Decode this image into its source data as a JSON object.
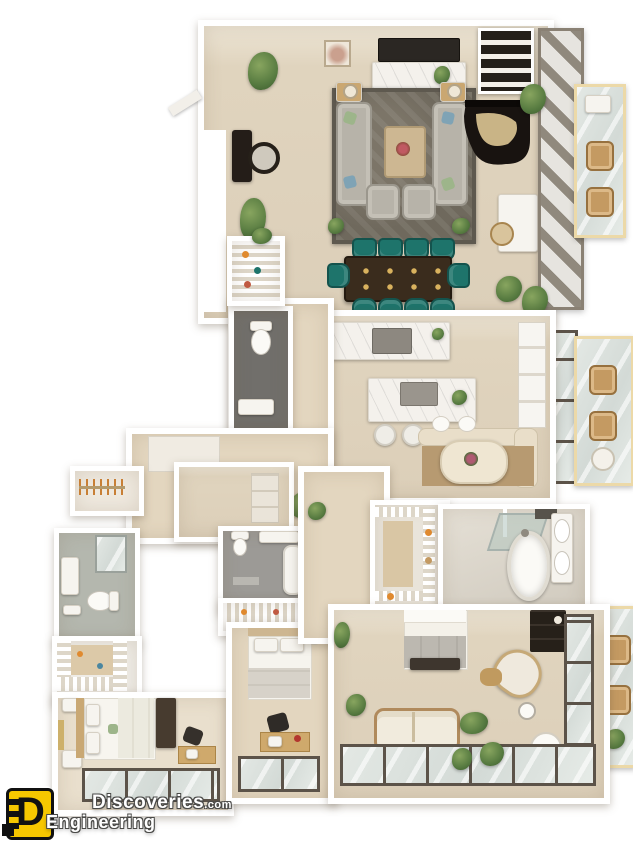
{
  "watermark": {
    "logo": "D",
    "brand_top": "Discoveries",
    "brand_tld": ".com",
    "brand_bottom": "Engineering"
  },
  "colors": {
    "bg": "#ffffff",
    "wall": "#ffffff",
    "floor": "#dccfb9",
    "floor_light": "#e9dfcd",
    "floor_warm": "#e3d6bf",
    "rug": "#6f695d",
    "sofa": "#b7b3a9",
    "teal": "#1e746b",
    "table_wood": "#3a2c1d",
    "piano": "#181310",
    "marble": "#f4f1ec",
    "bath_dark": "#716f6b",
    "bath_mid": "#9c9a96",
    "bath_sage": "#b4b7ae",
    "glass": "#d3dad6",
    "frame_dark": "#5c5349",
    "balcony_trim": "#ecd9a8",
    "wood": "#c49a62",
    "plant": "#567a40",
    "logo_yellow": "#f6c700",
    "text_white": "#ffffff"
  }
}
